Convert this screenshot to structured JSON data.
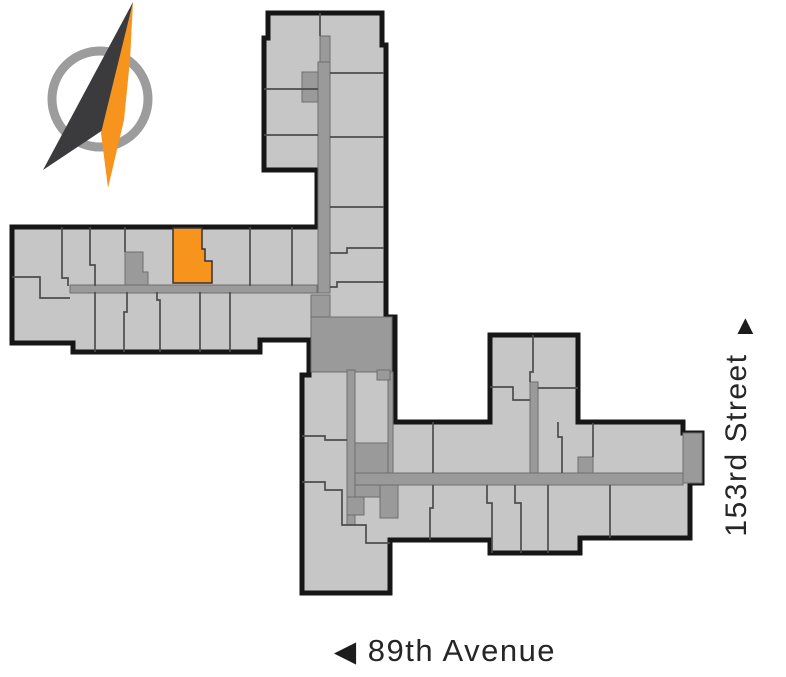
{
  "labels": {
    "street_right": {
      "text": "153rd Street",
      "arrow": "▲",
      "direction": "north"
    },
    "street_bottom": {
      "text": "89th Avenue",
      "arrow": "◀",
      "direction": "west"
    },
    "text_color": "#262626"
  },
  "floorplan": {
    "unit_fill": "#c6c6c6",
    "corridor_fill": "#9a9a9a",
    "outline_color": "#161616",
    "divider_color": "#4d4d4d",
    "highlight_color": "#f7941e",
    "highlighted_unit": "selected-unit"
  },
  "compass": {
    "ring_color": "#9c9c9c",
    "needle_dark_color": "#3b3b3d",
    "needle_orange_color": "#f7941e"
  }
}
